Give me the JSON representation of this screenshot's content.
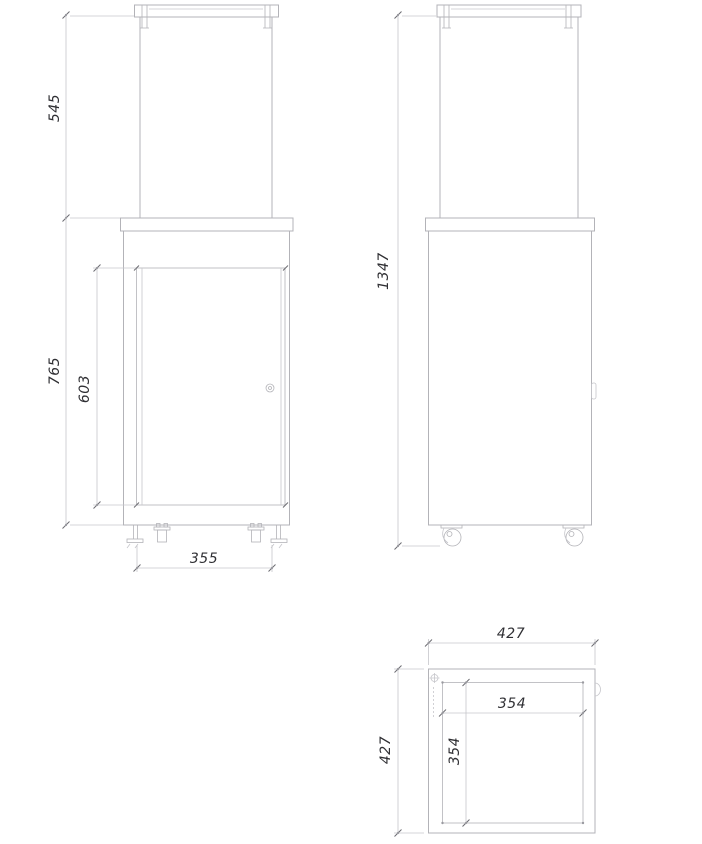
{
  "colors": {
    "background": "#ffffff",
    "outline": "#b3b3b8",
    "lightline": "#c6c6cb",
    "tick": "#6d6d73",
    "text": "#2f2f33"
  },
  "front_view": {
    "glass_height": "545",
    "body_height": "765",
    "door_height": "603",
    "base_width": "355"
  },
  "side_view": {
    "total_height": "1347"
  },
  "top_view": {
    "outer_width": "427",
    "outer_depth": "427",
    "inner_width": "354",
    "inner_depth": "354"
  }
}
